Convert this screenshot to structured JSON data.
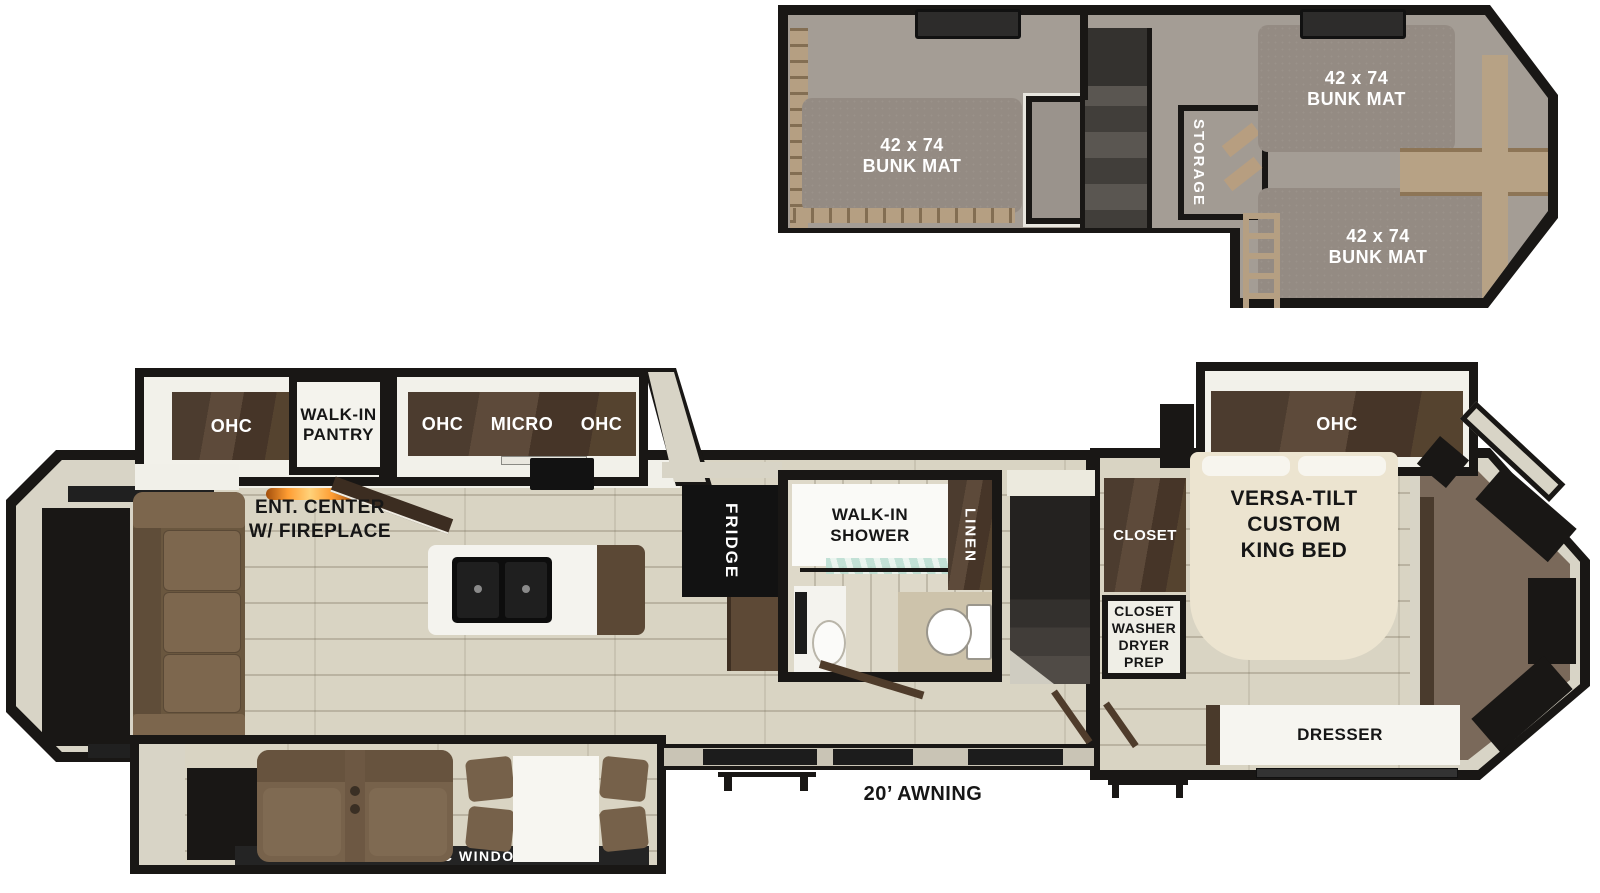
{
  "palette": {
    "wall": "#191715",
    "floor_wood": "#d9d4c3",
    "loft_carpet": "#a49d95",
    "bunk_mat": "#948b83",
    "cabinet_wood": "#4c3c2f",
    "sofa_brown": "#6e5a42",
    "bed_cream": "#ece4d0",
    "bedroom_carpet": "#7a695a",
    "fireplace_accent": "#ff9d33",
    "shower_glass": "#bcded2"
  },
  "loft": {
    "mat_left": {
      "l1": "42 x 74",
      "l2": "BUNK MAT"
    },
    "mat_top_right": {
      "l1": "42 x 74",
      "l2": "BUNK MAT"
    },
    "mat_bottom_right": {
      "l1": "42 x 74",
      "l2": "BUNK MAT"
    },
    "storage": "STORAGE"
  },
  "living": {
    "ohc_rear": "OHC",
    "pantry_l1": "WALK-IN",
    "pantry_l2": "PANTRY",
    "kitchen_ohc_left": "OHC",
    "kitchen_micro": "MICRO",
    "kitchen_ohc_right": "OHC",
    "ent_l1": "ENT. CENTER",
    "ent_l2": "W/ FIREPLACE",
    "fridge": "FRIDGE",
    "awning": "20’ AWNING",
    "panoramic_window": "PANORAMIC WINDOW"
  },
  "bath": {
    "shower_l1": "WALK-IN",
    "shower_l2": "SHOWER",
    "linen": "LINEN"
  },
  "bedroom": {
    "closet": "CLOSET",
    "wd_l1": "CLOSET",
    "wd_l2": "WASHER",
    "wd_l3": "DRYER",
    "wd_l4": "PREP",
    "bed_l1": "VERSA-TILT",
    "bed_l2": "CUSTOM",
    "bed_l3": "KING BED",
    "ohc": "OHC",
    "dresser": "DRESSER"
  }
}
